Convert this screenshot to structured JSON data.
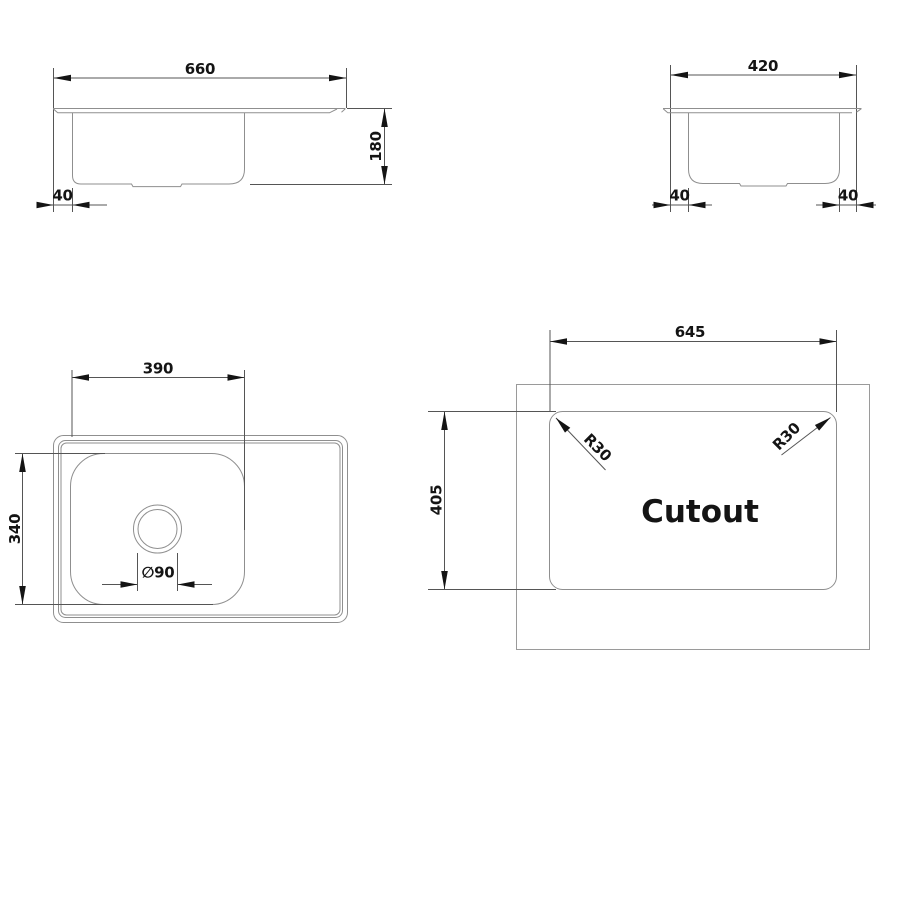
{
  "colors": {
    "background": "#ffffff",
    "object_line": "#8f8f8f",
    "dimension_line": "#555555",
    "ink": "#141414"
  },
  "front_view": {
    "width_mm": "660",
    "depth_mm": "180",
    "rim_offset_mm": "40"
  },
  "side_view": {
    "width_mm": "420",
    "left_offset_mm": "40",
    "right_offset_mm": "40"
  },
  "plan_view": {
    "bowl_width_mm": "390",
    "bowl_length_mm": "340",
    "drain_diameter": "∅90"
  },
  "cutout_view": {
    "width_mm": "645",
    "height_mm": "405",
    "corner_radius_left": "R30",
    "corner_radius_right": "R30",
    "label": "Cutout"
  }
}
